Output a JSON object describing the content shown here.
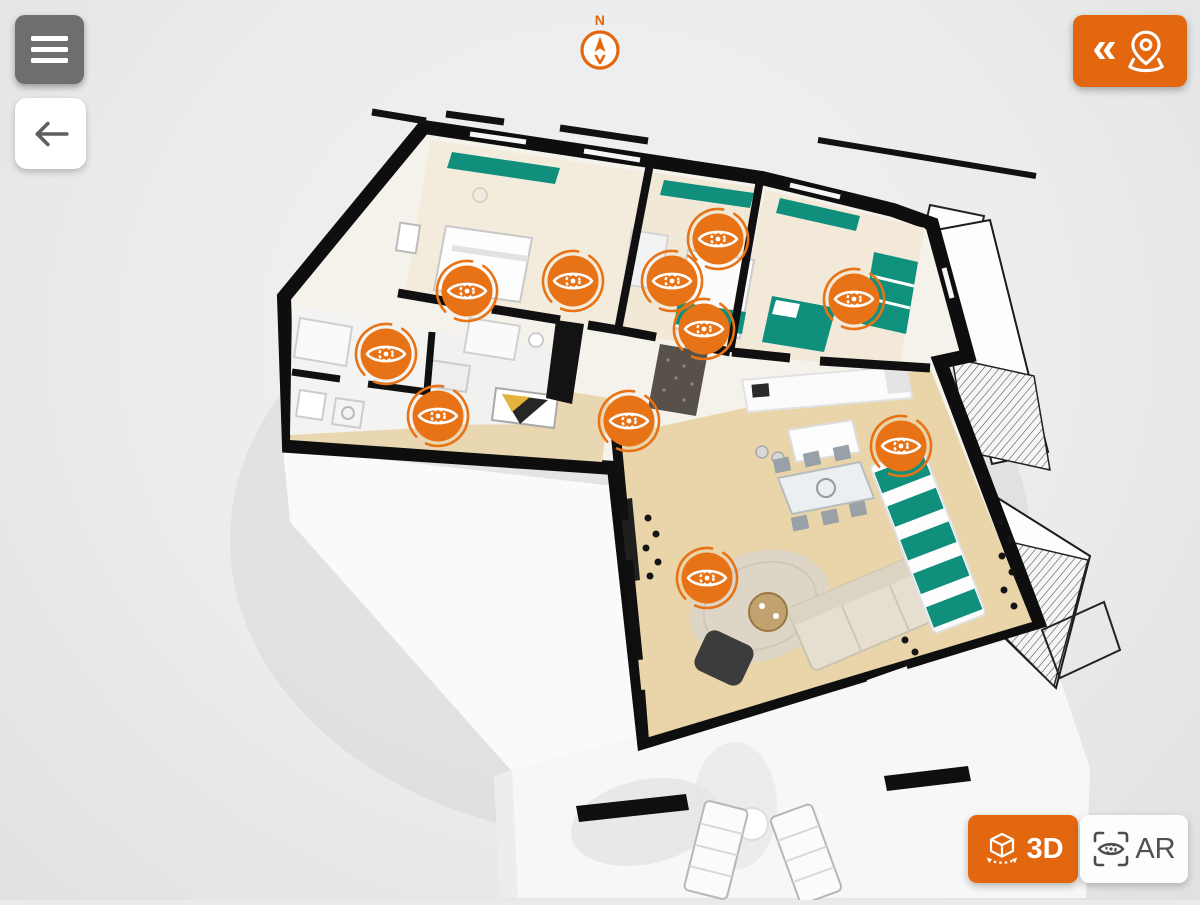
{
  "colors": {
    "ui_orange": "#e2670e",
    "marker_orange": "#e87317",
    "teal_accent": "#0f8f7c",
    "wall_black": "#0e0e0e",
    "background": "#ebecec"
  },
  "top_bar": {
    "menu_button": {
      "icon": "hamburger-icon"
    },
    "back_button": {
      "icon": "arrow-left-icon"
    },
    "compass": {
      "north_label": "N",
      "icon": "compass-needle-icon"
    },
    "panorama_button": {
      "chevrons": "«",
      "icon": "map-pin-icon"
    }
  },
  "view_mode_switch": {
    "mode_3d": {
      "label": "3D",
      "icon": "cube-3d-icon",
      "active": true
    },
    "mode_ar": {
      "label": "AR",
      "icon": "ar-eye-icon",
      "active": false
    }
  },
  "floor_plan": {
    "viewpoints": [
      {
        "x": 467,
        "y": 291
      },
      {
        "x": 573,
        "y": 281
      },
      {
        "x": 672,
        "y": 281
      },
      {
        "x": 718,
        "y": 239
      },
      {
        "x": 704,
        "y": 329
      },
      {
        "x": 854,
        "y": 299
      },
      {
        "x": 386,
        "y": 354
      },
      {
        "x": 438,
        "y": 416
      },
      {
        "x": 629,
        "y": 421
      },
      {
        "x": 901,
        "y": 446
      },
      {
        "x": 707,
        "y": 578
      }
    ]
  }
}
